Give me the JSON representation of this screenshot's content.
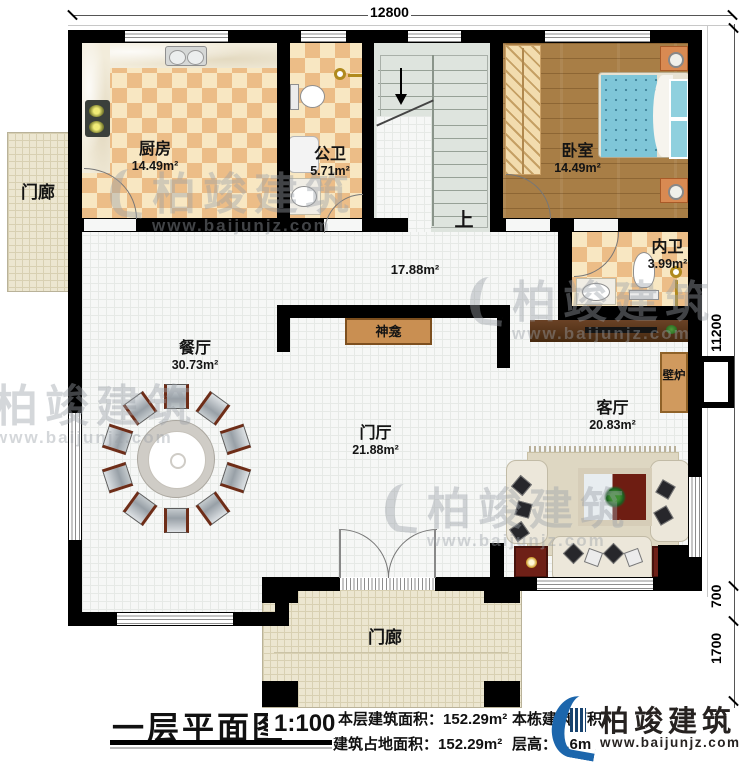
{
  "plan": {
    "dim_top": "12800",
    "dim_right_main": "11200",
    "dim_right_mid": "700",
    "dim_right_low": "1700",
    "stairs_up": "上",
    "rooms": {
      "porch_left": {
        "name": "门廊"
      },
      "kitchen": {
        "name": "厨房",
        "area": "14.49m²"
      },
      "public_bath": {
        "name": "公卫",
        "area": "5.71m²"
      },
      "bedroom": {
        "name": "卧室",
        "area": "14.49m²"
      },
      "ensuite_bath": {
        "name": "内卫",
        "area": "3.99m²"
      },
      "hallway": {
        "area": "17.88m²"
      },
      "shrine": {
        "name": "神龛"
      },
      "dining": {
        "name": "餐厅",
        "area": "30.73m²"
      },
      "foyer": {
        "name": "门厅",
        "area": "21.88m²"
      },
      "living": {
        "name": "客厅",
        "area": "20.83m²"
      },
      "fireplace": {
        "name": "壁炉"
      },
      "porch_bottom": {
        "name": "门廊"
      }
    }
  },
  "title_block": {
    "title": "一层平面图",
    "scale": "1:100",
    "stats": [
      {
        "label": "本层建筑面积：",
        "value": "152.29m²"
      },
      {
        "label": "建筑占地面积：",
        "value": "152.29m²"
      },
      {
        "label": "本栋建筑面积：",
        "value": ""
      },
      {
        "label": "层高：",
        "value": "3.6m"
      }
    ]
  },
  "branding": {
    "name": "柏竣建筑",
    "url": "www.baijunjz.com"
  },
  "watermark": {
    "name": "柏竣建筑",
    "url": "www.baijunjz.com"
  },
  "colors": {
    "wall": "#000000",
    "checker_dark": "#ecbd87",
    "checker_light": "#f8e7c2",
    "wood": "#a87e46",
    "brand_blue": "#1c66ac"
  }
}
